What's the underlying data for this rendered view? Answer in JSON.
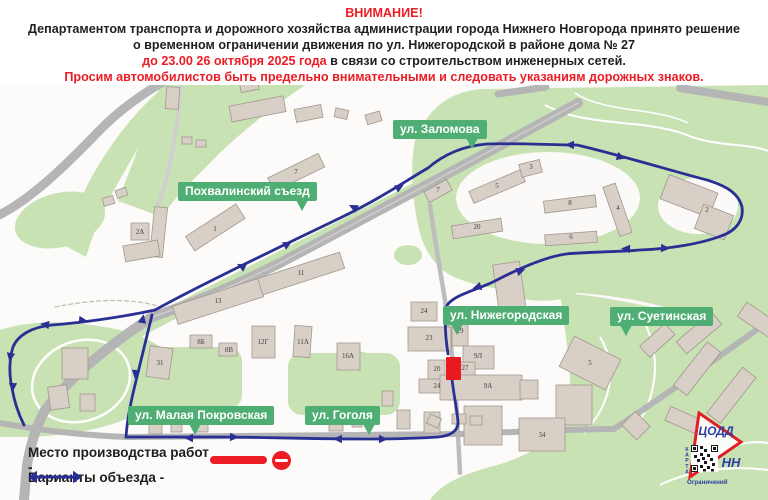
{
  "header": {
    "title": "ВНИМАНИЕ!",
    "line1": "Департаментом транспорта и дорожного хозяйства администрации города Нижнего Новгорода принято решение",
    "line2": "о временном ограничении движения по ул. Нижегородской в районе дома № 27",
    "period_red": "до 23.00 26 октября 2025 года",
    "period_rest": " в связи со строительством инженерных сетей.",
    "line4": "Просим автомобилистов быть предельно внимательными и следовать указаниям дорожных знаков."
  },
  "map": {
    "street_labels": {
      "zalomova": "ул. Заломова",
      "pokhvalinsky": "Похвалинский съезд",
      "nizhegorodskaya": "ул. Нижегородская",
      "suetinskaya": "ул. Суетинская",
      "malaya_pokrovskaya": "ул. Малая Покровская",
      "gogolya": "ул. Гоголя"
    },
    "building_numbers": [
      "2А",
      "1",
      "7",
      "5",
      "7",
      "3",
      "8",
      "4",
      "20",
      "6",
      "2",
      "13",
      "11",
      "24",
      "23",
      "29",
      "9Л",
      "20",
      "27",
      "24",
      "9А",
      "5",
      "34",
      "8Б",
      "8В",
      "12Г",
      "11А",
      "16А",
      "31"
    ]
  },
  "legend": {
    "work_site": "Место производства работ -",
    "detour": "Варианты объезда  -"
  },
  "logo": {
    "org": "ЦОДД",
    "city": "НН",
    "vertical": "КАРТА",
    "bottom": "Ограничений"
  },
  "colors": {
    "accent_red": "#ec1c24",
    "route_blue": "#2a3093",
    "label_green": "#4fae73",
    "map_green": "#c9e2b4",
    "road_gray": "#b5b5b5"
  }
}
